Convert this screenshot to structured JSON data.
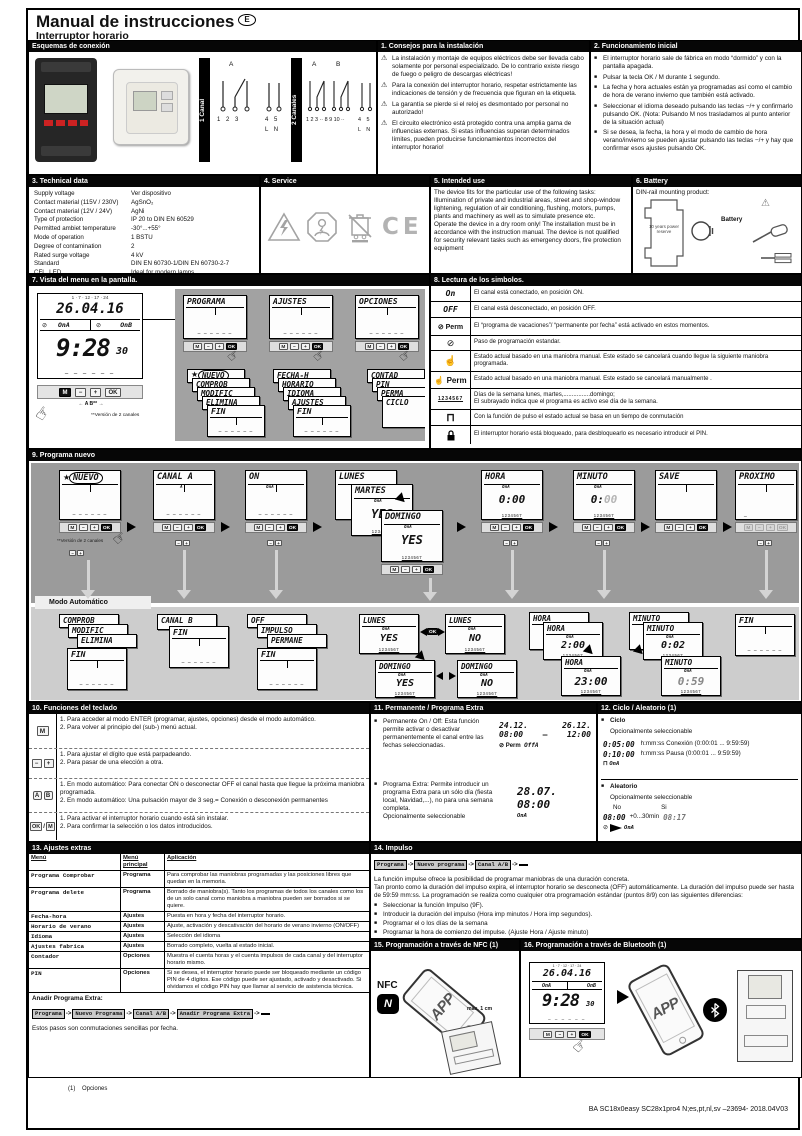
{
  "page": {
    "title": "Manual de instrucciones",
    "lang_badge": "E",
    "subtitle": "Interruptor horario",
    "footer": "BA SC18x0easy SC28x1pro4 N;es,pt,nl,sv –23694- 2018.04V03",
    "footnote_num": "(1)",
    "footnote_text": "Opciones"
  },
  "glyphs": {
    "star": "★",
    "perm": "⊘",
    "pulse": "⊓",
    "hand_up": "☝",
    "hand_press": "☞",
    "warning": "⚠",
    "bullet": "■",
    "days": "1234567",
    "dashes": "– – – – – –",
    "crumb_sep": "->",
    "ok": "OK"
  },
  "wiring": {
    "header": "Esquemas de conexión",
    "ch1_label": "1 Canal",
    "ch2_label": "2 Canales",
    "a": "A",
    "b": "B",
    "ch1_numbers": "1   2   3",
    "ch1_power": "4   5",
    "ch1_ln": "L   N",
    "ch2_numbers": "1 2 3 ·· 8 9 10 ··",
    "ch2_power": "4  5",
    "ch2_ln": "L  N"
  },
  "s1": {
    "header": "1. Consejos para la instalación",
    "items": [
      "La instalación y montaje de equipos eléctricos debe ser llevada cabo solamente por personal especializado. De lo contrario existe riesgo de fuego o peligro de descargas eléctricas!",
      "Para la conexión del interruptor horario, respetar estrictamente las indicaciones de tensión y de frecuencia que figuran en la etiqueta.",
      "La garantía se pierde si el reloj es desmontado por personal no autorizado!",
      "El circuito electrónico está protegido contra una amplia gama de influencias externas. Si estas influencias superan determinados límites, pueden producirse funcionamientos incorrectos del interruptor horario!"
    ]
  },
  "s2": {
    "header": "2. Funcionamiento inicial",
    "items": [
      "El interruptor horario sale de fábrica en modo “dormido” y con la pantalla apagada.",
      "Pulsar la tecla OK / M durante 1 segundo.",
      "La fecha y hora actuales están ya programadas así como el cambio de hora de verano invierno que también está activado.",
      "Seleccionar el idioma deseado pulsando las teclas −/+ y confirmarlo pulsando OK. (Nota: Pulsando M nos trasladamos al punto anterior de la situación actual)",
      "Si se desea, la fecha, la hora y el modo de cambio de hora verano/invierno se pueden ajustar pulsando las teclas −/+ y hay que confirmar esos ajustes pulsando OK."
    ]
  },
  "s3": {
    "header": "3. Technical data",
    "rows": [
      {
        "label": "Supply voltage",
        "value": "Ver dispositivo"
      },
      {
        "label": "Contact material (115V / 230V)",
        "value": "AgSnO₂"
      },
      {
        "label": "Contact material (12V / 24V)",
        "value": "AgNi"
      },
      {
        "label": "Type of protection",
        "value": "IP 20 to DIN EN 60529"
      },
      {
        "label": "Permitted ambiet temperature",
        "value": "-30°...+55°"
      },
      {
        "label": "Mode of operation",
        "value": "1 BSTU"
      },
      {
        "label": "Degree of contamination",
        "value": "2"
      },
      {
        "label": "Rated surge voltage",
        "value": "4 kV"
      },
      {
        "label": "Standard",
        "value": "DIN EN 60730-1/DIN EN 60730-2-7"
      },
      {
        "label": "CFL, LED",
        "value": "Ideal for modern lamps"
      }
    ]
  },
  "s4": {
    "header": "4. Service",
    "ce": "CE"
  },
  "s5": {
    "header": "5. Intended use",
    "p1": "The device fits for the particular use of the following tasks: Illumination of private and industrial areas, street and shop-window lightening, regulation of air conditioning, flushing, motors, pumps, plants and machinery as well as to simulate presence etc.",
    "p2": "Operate the device in a dry room only! The installation must be in accordance with the instruction manual. The device is not qualified for security relevant tasks such as emergency doors, fire protection equipment"
  },
  "s6": {
    "header": "6. Battery",
    "intro": "DIN-rail mounting product:",
    "battery": "Battery",
    "reserve": "10 years power reserve"
  },
  "s7": {
    "header": "7. Vista del menu en la pantalla.",
    "lcd": {
      "ruler": "1 · 7 · 12 · 17 · 24",
      "date": "26.04.16",
      "onA": "OnA",
      "onB": "OnB",
      "time": "9:28",
      "sec": "30"
    },
    "keys": {
      "m": "M",
      "minus": "−",
      "plus": "+",
      "ok": "OK"
    },
    "keylabels": "←    A    B**    →",
    "note": "**Versión de 2 canales",
    "menus": [
      "PROGRAMA",
      "AJUSTES",
      "OPCIONES"
    ],
    "sub1": [
      "NUEVO",
      "COMPROB",
      "MODIFIC",
      "ELIMINA",
      "FIN"
    ],
    "sub2": [
      "FECHA-H",
      "HORARIO",
      "IDIOMA",
      "AJUSTES",
      "FIN"
    ],
    "sub3": [
      "CONTAD",
      "PIN",
      "PERMA",
      "CICLO"
    ]
  },
  "s8": {
    "header": "8. Lectura de los simbolos.",
    "rows": [
      {
        "sym": "On",
        "desc": "El canal está conectado, en posición ON."
      },
      {
        "sym": "OFF",
        "desc": "El canal está desconectado, en posición OFF."
      },
      {
        "sym": "⊘ Perm",
        "desc": "El “programa de vacaciones”/ “permanente por fecha” está activado en estos momentos."
      },
      {
        "sym": "⊘",
        "desc": "Paso de programación estandar."
      },
      {
        "sym": "☝",
        "desc": "Estado actual basado en una maniobra manual. Este estado se cancelará cuando llegue la siguiente maniobra programada."
      },
      {
        "sym": "☝ Perm",
        "desc": "Estado actual basado en una maniobra manual. Este estado se cancelará manualmente ."
      },
      {
        "sym": "1234567",
        "desc": "Días de la semana lunes, martes,................domingo;",
        "desc2": "El subrayado indica que el programa es activo ese día de la semana."
      },
      {
        "sym": "⊓",
        "desc": "Con la función de pulso el estado actual se basa en un tiempo de conmutación"
      },
      {
        "sym": "",
        "desc": "El interruptor horario está bloqueado, para desbloquearlo es necesario introducir el PIN."
      }
    ]
  },
  "s9": {
    "header": "9. Programa nuevo",
    "mode": "Modo Automático",
    "note": "**Versión de 2 canales",
    "t1": "NUEVO",
    "t2": "CANAL A",
    "t3": "ON",
    "t4": "LUNES",
    "t4b": "MARTES",
    "t4c": "DOMINGO",
    "t5": "HORA",
    "t6": "MINUTO",
    "t7": "SAVE",
    "t8": "PROXIMO",
    "yes": "YES",
    "no": "NO",
    "ch_a": "A",
    "ch_onA": "OnA",
    "v_hora": "0:00",
    "v_min_a": "0:",
    "v_min_b": "00",
    "v_prox": "_",
    "ok": "OK",
    "stack1": [
      "COMPROB",
      "MODIFIC",
      "ELIMINA",
      "FIN"
    ],
    "stack2": [
      "CANAL B",
      "FIN"
    ],
    "stack3": [
      "OFF",
      "IMPULSO",
      "PERMANE",
      "FIN"
    ],
    "b_lunes": "LUNES",
    "b_domingo": "DOMINGO",
    "hora_vals": [
      "0:00",
      "2:00",
      "23:00"
    ],
    "min_vals": [
      "0:01",
      "0:02",
      "0:59"
    ],
    "b_fin": "FIN"
  },
  "s10": {
    "header": "10. Funciones del teclado",
    "rows": [
      {
        "k1": "M",
        "l1": "1. Para acceder al modo ENTER (programar, ajustes, opciones) desde el modo automático.",
        "l2": "2. Para volver al principio del (sub-) menú actual."
      },
      {
        "k1": "−",
        "k2": "+",
        "l1": "1. Para ajustar el dígito que está parpadeando.",
        "l2": "2. Para pasar de una elección a otra."
      },
      {
        "k1": "A",
        "k2": "B",
        "l1": "1. En modo automático: Para conectar ON o desconectar OFF el canal hasta que llegue la próxima maniobra programada.",
        "l2": "2. En modo automático: Una pulsación mayor de 3 seg.= Conexión o desconexión permanentes"
      },
      {
        "k1": "OK",
        "sep": "/",
        "k2": "M",
        "l1": "1. Para activar el interruptor horario cuando está sin instalar.",
        "l2": "2. Para confirmar la selección o los datos introducidos."
      }
    ]
  },
  "s11": {
    "header": "11. Permanente / Programa Extra",
    "b1": "Permanente On / Off: Esta función permite activar o desactivar permanentemente el canal entre las fechas seleccionadas.",
    "d1a": "24.12.",
    "t1a": "08:00",
    "d1b": "26.12.",
    "t1b": "12:00",
    "dash": "–",
    "perm": "Perm",
    "ch1": "OffA",
    "b2": "Programa Extra: Permite introducir un programa Extra para un sólo día (fiesta local, Navidad,...), no para una semana completa.",
    "opt": "Opcionalmente seleccionable",
    "d2": "28.07.",
    "t2": "08:00",
    "ch2": "OnA"
  },
  "s12": {
    "header": "12. Ciclo / Aleatorio (1)",
    "ciclo": "Ciclo",
    "opt": "Opcionalmente seleccionable",
    "c1": "0:05:00",
    "c1d": "h:mm:ss Conexión (0:00:01 ... 9:59:59)",
    "c2": "0:10:00",
    "c2d": "h:mm:ss Pausa (0:00:01 ... 9:59:59)",
    "c_ch": "OnA",
    "alea": "Aleatorio",
    "no": "No",
    "si": "Si",
    "a1": "08:00",
    "aplus": "+0...30min",
    "a2": "08:17",
    "a_ch": "OnA"
  },
  "s13": {
    "header": "13. Ajustes extras",
    "cols": [
      "Menú",
      "Menú principal",
      "Aplicación"
    ],
    "rows": [
      {
        "menu": "Programa Comprobar",
        "main": "Programa",
        "app": "Para comprobar las maniobras programadas y las posiciones libres que quedan en la memoria."
      },
      {
        "menu": "Programa delete",
        "main": "Programa",
        "app": "Borrado de maniobra(s). Tanto los programas de todos los canales como los de un solo canal como maniobra a maniobra pueden ser borrados si se quiere."
      },
      {
        "menu": "Fecha-hora",
        "main": "Ajustes",
        "app": "Puesta en hora y fecha del interruptor horario."
      },
      {
        "menu": "Horario de verano",
        "main": "Ajustes",
        "app": "Ajuste, activación y descativación del horario de verano invierno (ON/OFF)"
      },
      {
        "menu": "Idioma",
        "main": "Ajustes",
        "app": "Selección del idioma"
      },
      {
        "menu": "Ajustes fabrica",
        "main": "Ajustes",
        "app": "Borrado completo, vuelta al estado inicial."
      },
      {
        "menu": "Contador",
        "main": "Opciones",
        "app": "Muestra el cuenta horas y el cuenta impulsos de cada canal y del interruptor horario mismo."
      },
      {
        "menu": "PIN",
        "main": "Opciones",
        "app": "Si se desea, el interruptor horario puede ser bloqueado mediante un código PIN de 4 dígitos. Ese código puede ser ajustado, activado y desactivado. Si olvidamos el código PIN hay que llamar al servicio de asistencia técnica."
      }
    ],
    "extra_title": "Anadir Programa Extra:",
    "crumbs": [
      "Programa",
      "Nuevo Programa",
      "Canal A/B",
      "Anadir Programa Extra",
      ""
    ],
    "extra_note": "Estos pasos son conmutaciones sencillas por fecha."
  },
  "s14": {
    "header": "14. Impulso",
    "crumbs": [
      "Programa",
      "Nuevo programa",
      "Canal A/B",
      ""
    ],
    "p1": "La función impulse ofrece la posibilidad de programar maniobras de una duración concreta.",
    "p2": "Tan pronto como la duración del impulso expira, el interruptor horario se desconecta (OFF) automáticamente. La duración del impulso puede ser hasta de 59:59 mm:ss. La programación se realiza como cualquier otra programación estándar (puntos 8/9) con las siguientes diferencias:",
    "items": [
      "Seleccionar la función Impulso (9F).",
      "Introducir la duración del impulso (Hora imp minutos / Hora imp segundos).",
      "Programar el o los días de la semana",
      "Programar la hora de comienzo del impulse. (Ajuste Hora / Ajuste minuto)",
      "Validar: Confirmar la maniobra del impulse cuyo resumen aparece intermitente."
    ]
  },
  "s15": {
    "header": "15. Programación a través de NFC (1)",
    "nfc": "NFC",
    "app": "APP",
    "max": "max. 1 cm"
  },
  "s16": {
    "header": "16. Programación a través de Bluetooth (1)",
    "app": "APP"
  }
}
